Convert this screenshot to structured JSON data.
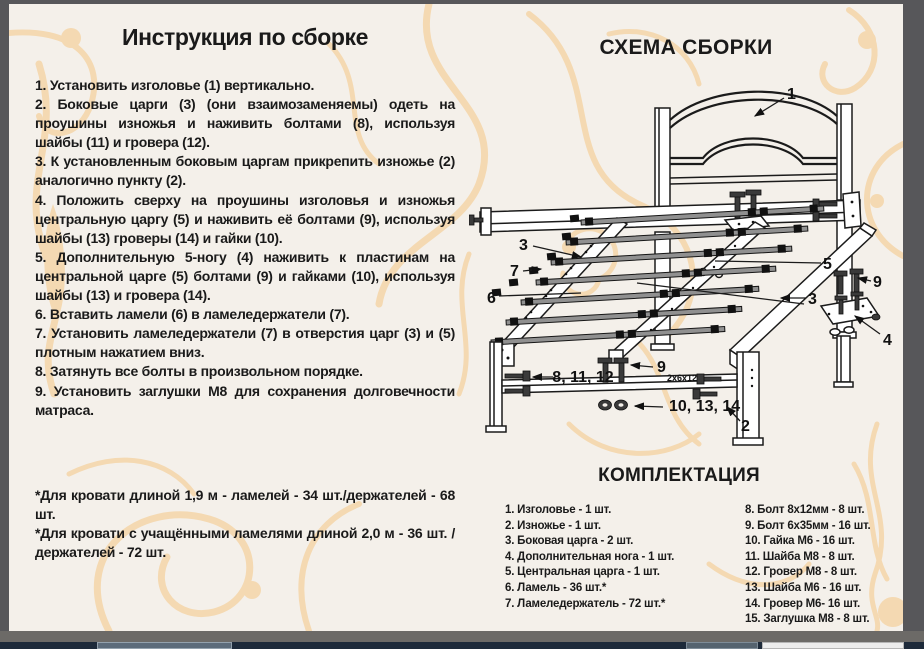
{
  "instructions": {
    "title": "Инструкция по сборке",
    "steps": [
      "1. Установить изголовье (1) вертикально.",
      "2. Боковые царги (3) (они взаимозаменяемы) одеть на проушины изножья и наживить болтами (8), используя шайбы (11) и гровера (12).",
      "3. К установленным боковым царгам прикрепить изножье (2) аналогично пункту (2).",
      "4. Положить сверху на проушины изголовья и изножья центральную царгу (5) и наживить её болтами (9), используя шайбы (13) гроверы (14) и гайки (10).",
      "5. Дополнительную 5-ногу (4) наживить к пластинам на центральной царге (5) болтами (9) и гайками (10), используя шайбы (13) и гровера (14).",
      "6. Вставить ламели (6) в ламеледержатели (7).",
      "7. Установить ламеледержатели (7) в отверстия царг (3) и (5) плотным нажатием вниз.",
      "8. Затянуть все болты в произвольном порядке.",
      "9. Установить заглушки М8 для сохранения долговечности матраса."
    ],
    "notes": [
      "*Для кровати длиной 1,9 м - ламелей - 34 шт./держателей - 68 шт.",
      "*Для кровати с учащёнными ламелями длиной 2,0 м - 36 шт. /держателей - 72 шт."
    ]
  },
  "diagram": {
    "title": "СХЕМА СБОРКИ",
    "callouts": {
      "headboard": "1",
      "footboard": "2",
      "side_rail_left": "3",
      "side_rail_right": "3",
      "extra_leg": "4",
      "central_rail": "5",
      "lamella": "6",
      "lamella_holder": "7",
      "bolts_vertical": "9",
      "bolts_leg": "9",
      "bolts_footboard": "8, 11, 12",
      "nuts_footboard": "10, 13, 14",
      "bolt_size_note": "2х6х12"
    }
  },
  "parts": {
    "title": "КОМПЛЕКТАЦИЯ",
    "col_left": [
      "1. Изголовье - 1 шт.",
      "2. Изножье - 1 шт.",
      "3. Боковая царга - 2 шт.",
      "4. Дополнительная нога - 1 шт.",
      "5. Центральная царга - 1 шт.",
      "6. Ламель - 36 шт.*",
      "7. Ламеледержатель - 72 шт.*"
    ],
    "col_right": [
      "8. Болт 8х12мм - 8 шт.",
      "9. Болт 6х35мм - 16 шт.",
      "10. Гайка М6 - 16 шт.",
      "11. Шайба М8 - 8 шт.",
      "12. Гровер М8 - 8 шт.",
      "13. Шайба М6 - 16 шт.",
      "14. Гровер М6- 16 шт.",
      "15. Заглушка М8 - 8 шт."
    ]
  },
  "colors": {
    "page_bg": "#f4f0ea",
    "ornament": "#f4d9b2",
    "ink": "#1a1a1a",
    "window_frame": "#57575a",
    "taskbar": "#1d2a3a"
  }
}
